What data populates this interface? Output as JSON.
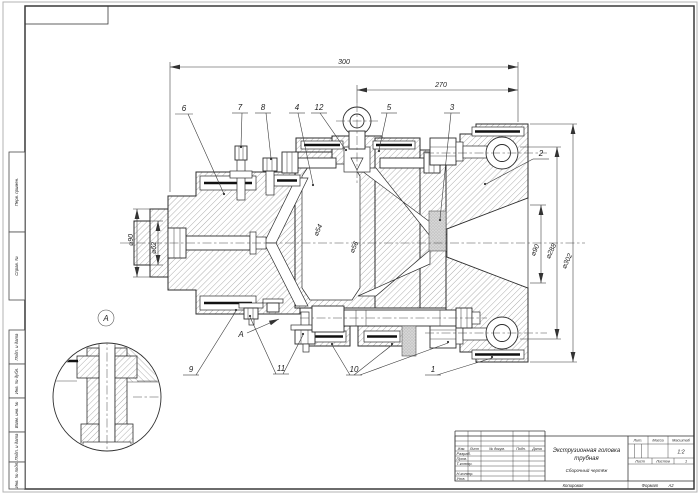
{
  "dims": {
    "len300": "300",
    "len270": "270",
    "d90l": "⌀90",
    "d62": "⌀62",
    "d54": "⌀54",
    "d56": "⌀56",
    "d90r": "⌀90",
    "d288": "⌀288",
    "d302": "⌀302"
  },
  "callouts": {
    "c1": "1",
    "c2": "2",
    "c3": "3",
    "c4": "4",
    "c5": "5",
    "c6": "6",
    "c7": "7",
    "c8": "8",
    "c9": "9",
    "c10": "10",
    "c11": "11",
    "c12": "12",
    "view_a": "А",
    "detail_a": "А"
  },
  "frame": {
    "left_labels": [
      "Перв. примен.",
      "Справ. №",
      "Подп. и дата",
      "Инв. № дубл.",
      "Взам. инв. №",
      "Подп. и дата",
      "Инв. № подл."
    ]
  },
  "title_block": {
    "header_cols": [
      "Изм.",
      "Лист",
      "№ докум.",
      "Подп.",
      "Дата"
    ],
    "rows": [
      "Разраб.",
      "Пров.",
      "Т.контр.",
      "Н.контр.",
      "Утв."
    ],
    "title_line1": "Экструзионная головка",
    "title_line2": "трубная",
    "doc_type": "Сборочный чертёж",
    "lit_label": "Лит.",
    "mass_label": "Масса",
    "scale_label": "Масштаб",
    "scale_value": "1:2",
    "sheet_label": "Лист",
    "sheets_label": "Листов",
    "sheets_value": "1",
    "copied_label": "Копировал",
    "format_label": "Формат",
    "format_value": "А2"
  }
}
